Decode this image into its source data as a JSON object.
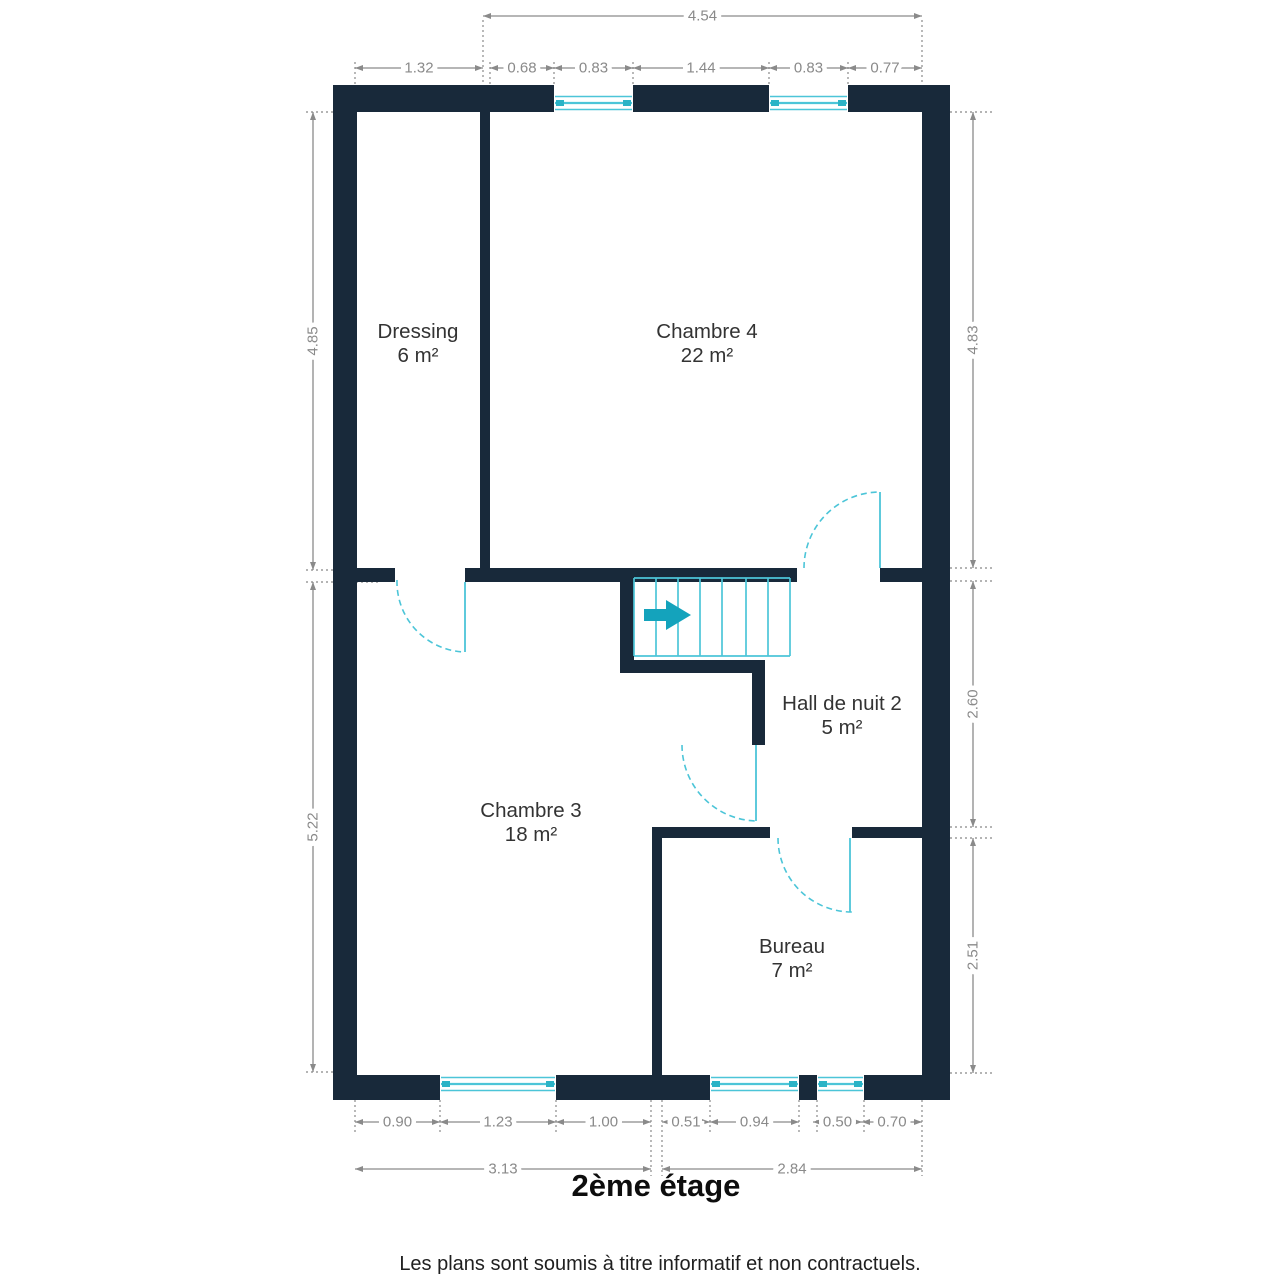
{
  "title": "2ème étage",
  "footer": "Les plans sont soumis à titre informatif et non contractuels.",
  "colors": {
    "wall": "#18293A",
    "accent": "#4CC5D8",
    "arrow": "#14A3BC",
    "dim": "#8A8A8A",
    "guide": "#9B9B9B",
    "label": "#333333"
  },
  "rooms": [
    {
      "name": "Dressing",
      "area": "6 m²",
      "x": 418,
      "y": 344
    },
    {
      "name": "Chambre 4",
      "area": "22 m²",
      "x": 707,
      "y": 344
    },
    {
      "name": "Chambre 3",
      "area": "18 m²",
      "x": 531,
      "y": 823
    },
    {
      "name": "Hall de nuit 2",
      "area": "5 m²",
      "x": 842,
      "y": 716
    },
    {
      "name": "Bureau",
      "area": "7 m²",
      "x": 792,
      "y": 959
    }
  ],
  "plan": {
    "walls": [
      [
        333,
        85,
        617,
        27
      ],
      [
        333,
        85,
        24,
        1015
      ],
      [
        922,
        85,
        28,
        1015
      ],
      [
        333,
        1075,
        617,
        25
      ],
      [
        480,
        112,
        10,
        456
      ],
      [
        333,
        568,
        62,
        14
      ],
      [
        465,
        568,
        332,
        14
      ],
      [
        880,
        568,
        42,
        14
      ],
      [
        620,
        578,
        14,
        82
      ],
      [
        620,
        660,
        145,
        13
      ],
      [
        752,
        660,
        13,
        85
      ],
      [
        652,
        827,
        118,
        11
      ],
      [
        852,
        827,
        70,
        11
      ],
      [
        652,
        838,
        10,
        237
      ]
    ],
    "windows": [
      {
        "x": 554,
        "y": 85,
        "w": 79,
        "h": 27,
        "band": "bottom"
      },
      {
        "x": 769,
        "y": 85,
        "w": 79,
        "h": 27,
        "band": "bottom"
      },
      {
        "x": 440,
        "y": 1075,
        "w": 116,
        "h": 25,
        "band": "top"
      },
      {
        "x": 710,
        "y": 1075,
        "w": 89,
        "h": 25,
        "band": "top"
      },
      {
        "x": 817,
        "y": 1075,
        "w": 47,
        "h": 25,
        "band": "top"
      }
    ],
    "doors": [
      {
        "leaf": [
          465,
          582,
          465,
          652
        ],
        "arc": [
          397,
          580,
          70,
          0,
          465,
          652
        ]
      },
      {
        "leaf": [
          880,
          492,
          880,
          568
        ],
        "arc": [
          804,
          568,
          76,
          1,
          880,
          492
        ]
      },
      {
        "leaf": [
          756,
          745,
          756,
          821
        ],
        "arc": [
          682,
          745,
          76,
          0,
          758,
          821
        ]
      },
      {
        "leaf": [
          850,
          838,
          850,
          912
        ],
        "arc": [
          778,
          838,
          74,
          0,
          852,
          912
        ]
      }
    ],
    "stairs": {
      "x": 634,
      "y": 578,
      "w": 156,
      "h": 78,
      "treads": [
        656,
        678,
        700,
        722,
        746,
        768
      ],
      "arrow_points": "644,609 666,609 666,600 691,615 666,630 666,621 644,621"
    },
    "dimensions": [
      {
        "dir": "h",
        "x1": 483,
        "x2": 922,
        "y": 16,
        "label": "4.54"
      },
      {
        "dir": "h",
        "x1": 355,
        "x2": 483,
        "y": 68,
        "label": "1.32"
      },
      {
        "dir": "h",
        "x1": 490,
        "x2": 554,
        "y": 68,
        "label": "0.68"
      },
      {
        "dir": "h",
        "x1": 554,
        "x2": 633,
        "y": 68,
        "label": "0.83"
      },
      {
        "dir": "h",
        "x1": 633,
        "x2": 769,
        "y": 68,
        "label": "1.44"
      },
      {
        "dir": "h",
        "x1": 769,
        "x2": 848,
        "y": 68,
        "label": "0.83"
      },
      {
        "dir": "h",
        "x1": 848,
        "x2": 922,
        "y": 68,
        "label": "0.77"
      },
      {
        "dir": "v",
        "y1": 112,
        "y2": 570,
        "x": 313,
        "label": "4.85"
      },
      {
        "dir": "v",
        "y1": 582,
        "y2": 1072,
        "x": 313,
        "label": "5.22"
      },
      {
        "dir": "v",
        "y1": 112,
        "y2": 568,
        "x": 973,
        "label": "4.83"
      },
      {
        "dir": "v",
        "y1": 581,
        "y2": 827,
        "x": 973,
        "label": "2.60"
      },
      {
        "dir": "v",
        "y1": 838,
        "y2": 1073,
        "x": 973,
        "label": "2.51"
      },
      {
        "dir": "h",
        "x1": 355,
        "x2": 440,
        "y": 1122,
        "label": "0.90"
      },
      {
        "dir": "h",
        "x1": 440,
        "x2": 556,
        "y": 1122,
        "label": "1.23"
      },
      {
        "dir": "h",
        "x1": 556,
        "x2": 651,
        "y": 1122,
        "label": "1.00"
      },
      {
        "dir": "h",
        "x1": 662,
        "x2": 710,
        "y": 1122,
        "label": "0.51"
      },
      {
        "dir": "h",
        "x1": 710,
        "x2": 799,
        "y": 1122,
        "label": "0.94"
      },
      {
        "dir": "h",
        "x1": 813,
        "x2": 862,
        "y": 1122,
        "label": "0.50"
      },
      {
        "dir": "h",
        "x1": 862,
        "x2": 922,
        "y": 1122,
        "label": "0.70"
      },
      {
        "dir": "h",
        "x1": 355,
        "x2": 651,
        "y": 1169,
        "label": "3.13"
      },
      {
        "dir": "h",
        "x1": 662,
        "x2": 922,
        "y": 1169,
        "label": "2.84"
      }
    ],
    "guides": [
      [
        483,
        20,
        483,
        112
      ],
      [
        922,
        20,
        922,
        85
      ],
      [
        355,
        62,
        355,
        85
      ],
      [
        490,
        62,
        490,
        85
      ],
      [
        554,
        62,
        554,
        112
      ],
      [
        633,
        62,
        633,
        112
      ],
      [
        769,
        62,
        769,
        112
      ],
      [
        848,
        62,
        848,
        112
      ],
      [
        306,
        112,
        333,
        112
      ],
      [
        306,
        570,
        380,
        570
      ],
      [
        306,
        582,
        380,
        582
      ],
      [
        306,
        1072,
        333,
        1072
      ],
      [
        950,
        112,
        995,
        112
      ],
      [
        925,
        568,
        995,
        568
      ],
      [
        925,
        581,
        995,
        581
      ],
      [
        925,
        827,
        995,
        827
      ],
      [
        925,
        838,
        995,
        838
      ],
      [
        950,
        1073,
        995,
        1073
      ],
      [
        355,
        1075,
        355,
        1132
      ],
      [
        440,
        1100,
        440,
        1132
      ],
      [
        556,
        1100,
        556,
        1132
      ],
      [
        651,
        1100,
        651,
        1176
      ],
      [
        662,
        1100,
        662,
        1176
      ],
      [
        710,
        1100,
        710,
        1132
      ],
      [
        799,
        1100,
        799,
        1132
      ],
      [
        817,
        1100,
        817,
        1132
      ],
      [
        864,
        1100,
        864,
        1132
      ],
      [
        922,
        1100,
        922,
        1176
      ]
    ]
  }
}
